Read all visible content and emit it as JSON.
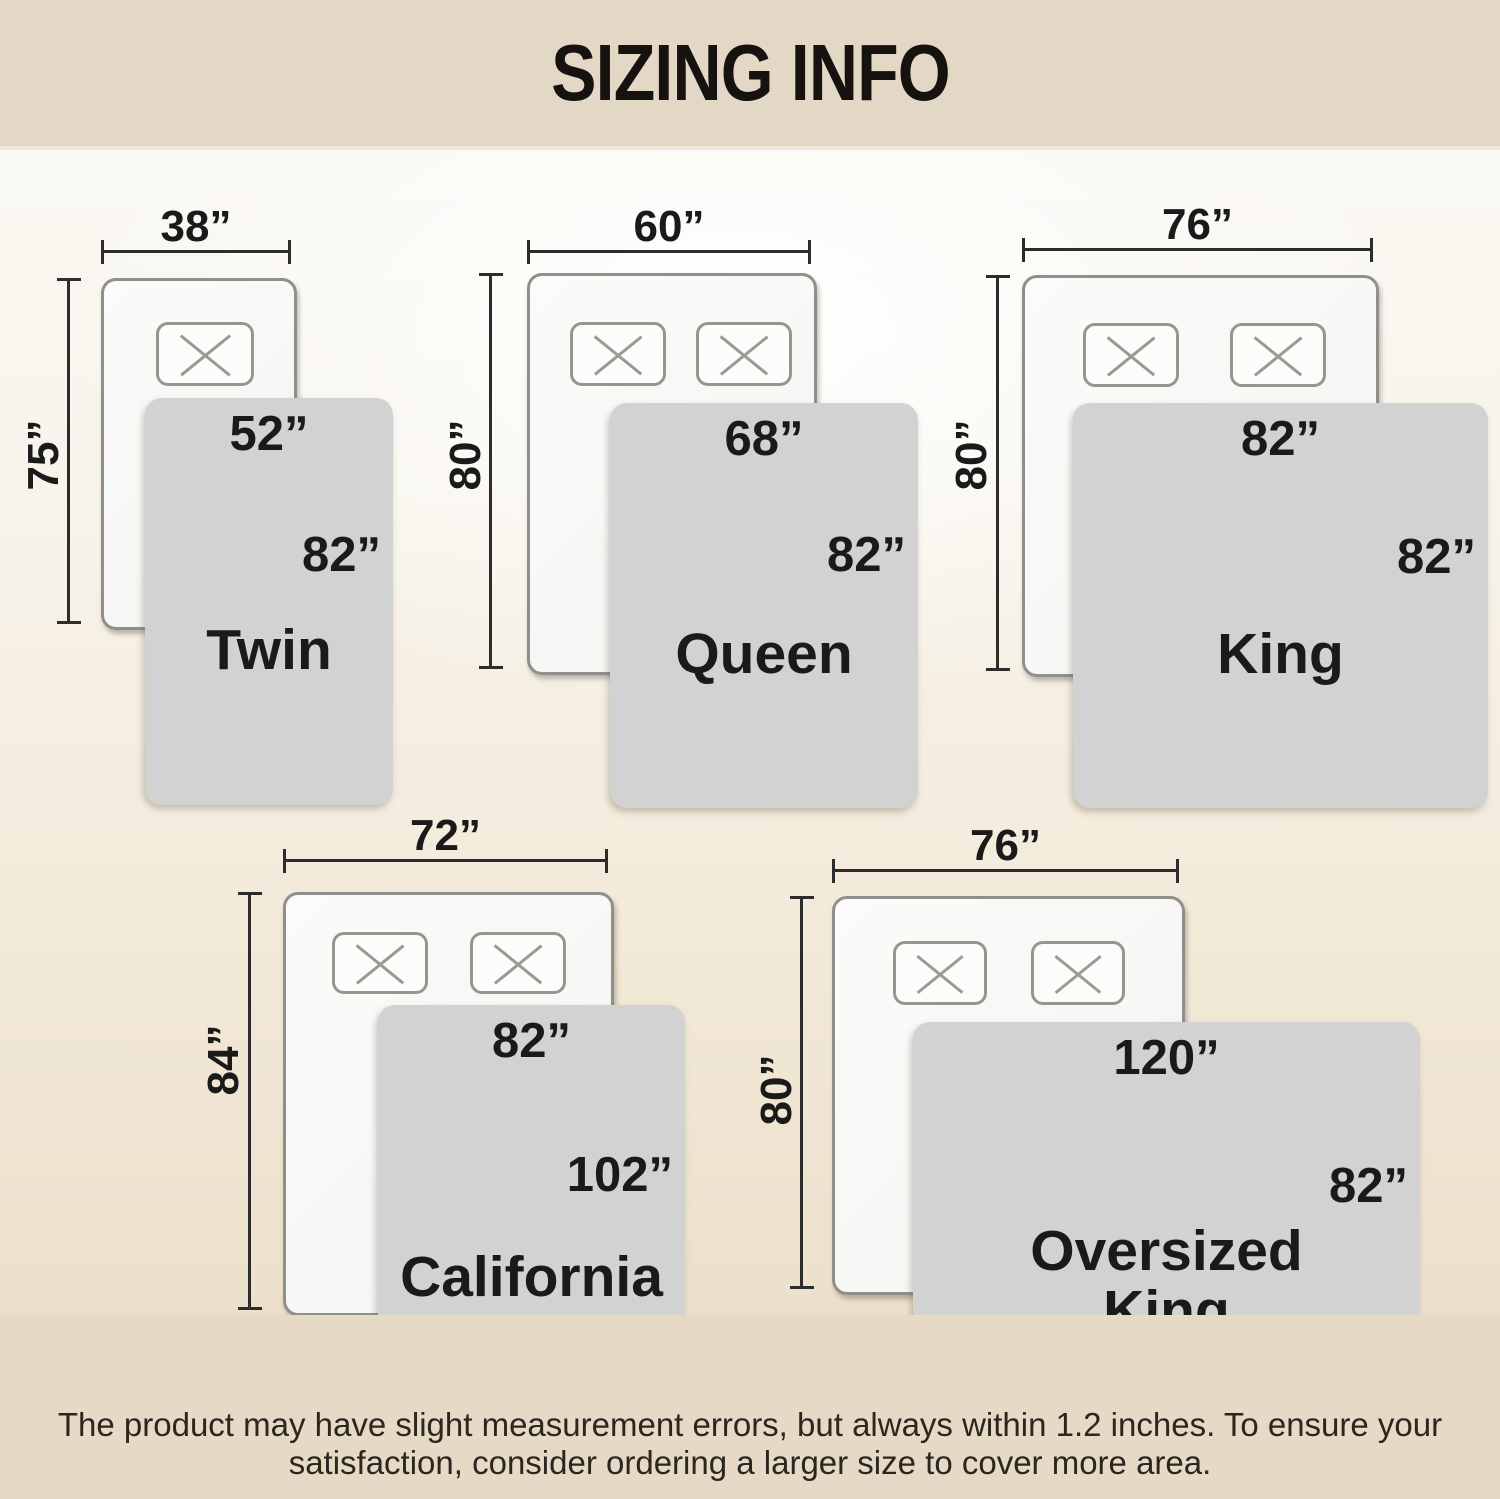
{
  "page": {
    "title": "SIZING INFO"
  },
  "footer": {
    "line1": "The product may have slight measurement errors, but always within 1.2 inches. To ensure your",
    "line2": "satisfaction, consider ordering a larger size to cover more area."
  },
  "sizes": [
    {
      "name_line1": "Twin",
      "name_line2": "",
      "bed_width": "38”",
      "bed_height": "75”",
      "blanket_width": "52”",
      "blanket_height": "82”",
      "pillows": 1
    },
    {
      "name_line1": "Queen",
      "name_line2": "",
      "bed_width": "60”",
      "bed_height": "80”",
      "blanket_width": "68”",
      "blanket_height": "82”",
      "pillows": 2
    },
    {
      "name_line1": "King",
      "name_line2": "",
      "bed_width": "76”",
      "bed_height": "80”",
      "blanket_width": "82”",
      "blanket_height": "82”",
      "pillows": 2
    },
    {
      "name_line1": "California",
      "name_line2": "King",
      "bed_width": "72”",
      "bed_height": "84”",
      "blanket_width": "82”",
      "blanket_height": "102”",
      "pillows": 2
    },
    {
      "name_line1": "Oversized",
      "name_line2": "King",
      "bed_width": "76”",
      "bed_height": "80”",
      "blanket_width": "120”",
      "blanket_height": "82”",
      "pillows": 2
    }
  ],
  "colors": {
    "header_band": "#e3d8c6",
    "footer_band": "#e6dac6",
    "blanket": "#d2d2d3",
    "bed_border": "#8f8f8c",
    "text": "#1a1a1a"
  }
}
